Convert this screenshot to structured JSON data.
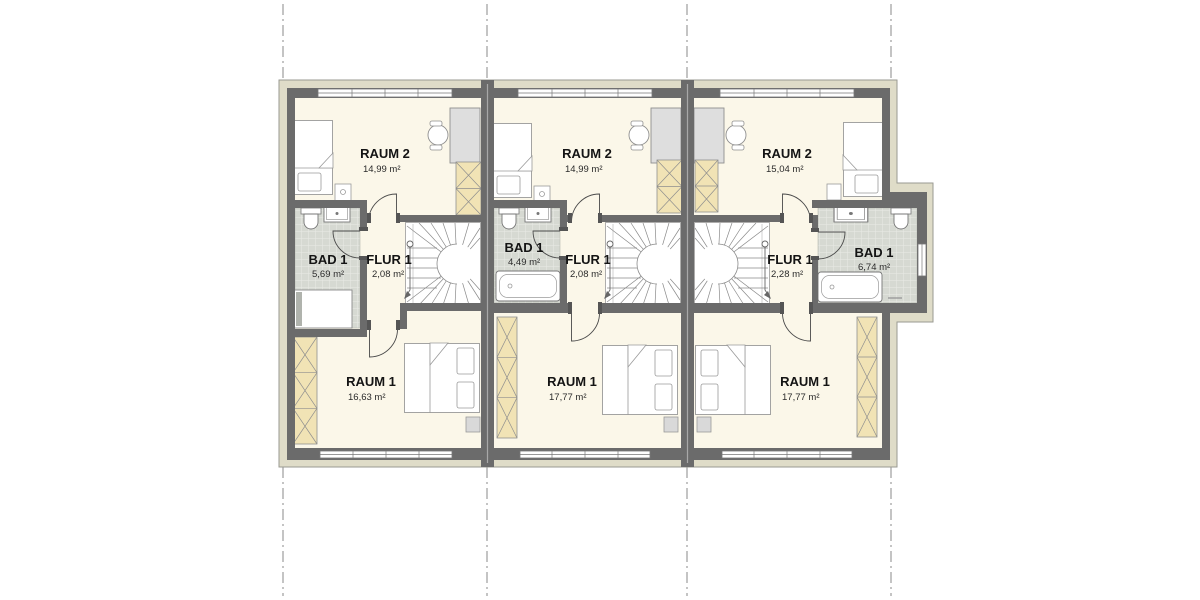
{
  "plan": {
    "title": "floor-plan-three-townhouse-units",
    "units": [
      {
        "label": "unit-1",
        "rooms": [
          {
            "name": "RAUM 2",
            "area": "14,99 m²"
          },
          {
            "name": "BAD 1",
            "area": "5,69 m²"
          },
          {
            "name": "FLUR 1",
            "area": "2,08 m²"
          },
          {
            "name": "RAUM 1",
            "area": "16,63 m²"
          }
        ]
      },
      {
        "label": "unit-2",
        "rooms": [
          {
            "name": "RAUM 2",
            "area": "14,99 m²"
          },
          {
            "name": "BAD 1",
            "area": "4,49 m²"
          },
          {
            "name": "FLUR 1",
            "area": "2,08 m²"
          },
          {
            "name": "RAUM 1",
            "area": "17,77 m²"
          }
        ]
      },
      {
        "label": "unit-3",
        "rooms": [
          {
            "name": "RAUM 2",
            "area": "15,04 m²"
          },
          {
            "name": "FLUR 1",
            "area": "2,28 m²"
          },
          {
            "name": "BAD 1",
            "area": "6,74 m²"
          },
          {
            "name": "RAUM 1",
            "area": "17,77 m²"
          }
        ]
      }
    ],
    "colors": {
      "wall": "#6b6b6b",
      "facade_band": "#dfdcc8",
      "floor": "#fbf7e9",
      "bathroom_tile": "#d6d9d2",
      "wardrobe": "#f1e3b5",
      "furniture_gray": "#dedede",
      "text": "#141414"
    }
  }
}
